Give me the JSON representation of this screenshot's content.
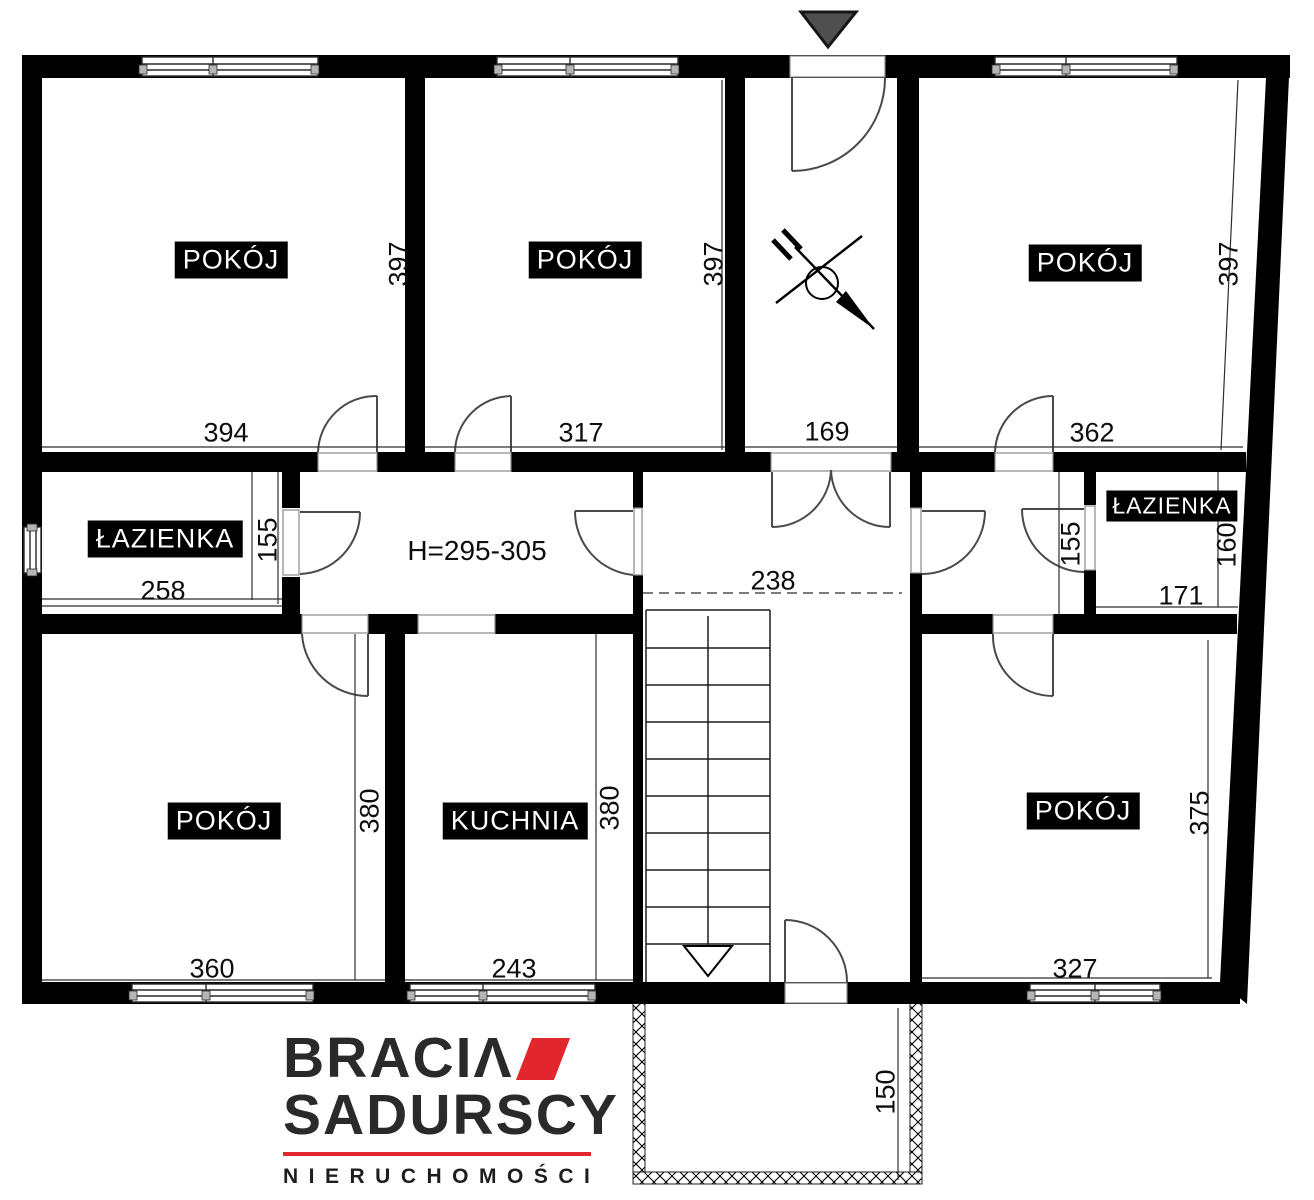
{
  "rooms": {
    "top_left": {
      "name": "POKÓJ",
      "width": "394",
      "height": "397"
    },
    "top_mid": {
      "name": "POKÓJ",
      "width": "317",
      "height": "397"
    },
    "top_right": {
      "name": "POKÓJ",
      "width": "362",
      "height": "397"
    },
    "bath_left": {
      "name": "ŁAZIENKA",
      "width": "258",
      "height": "155"
    },
    "bath_right": {
      "name": "ŁAZIENKA",
      "width": "171",
      "height": "160"
    },
    "bottom_left": {
      "name": "POKÓJ",
      "width": "360",
      "height": "380"
    },
    "kitchen": {
      "name": "KUCHNIA",
      "width": "243",
      "height": "380"
    },
    "bottom_right": {
      "name": "POKÓJ",
      "width": "327",
      "height": "375"
    }
  },
  "annotations": {
    "ceiling_height": "H=295-305",
    "entry_width": "169",
    "hall_width": "238",
    "vestibule_width": "155",
    "balcony_depth": "150"
  },
  "logo": {
    "brand_top": "BRACIΛ",
    "brand_bottom": "SADURSCY",
    "tagline": "NIERUCHOMOŚCI"
  },
  "colors": {
    "wall": "#000000",
    "accent_red": "#e2262d",
    "entrance_marker": "#4f4f4f"
  }
}
